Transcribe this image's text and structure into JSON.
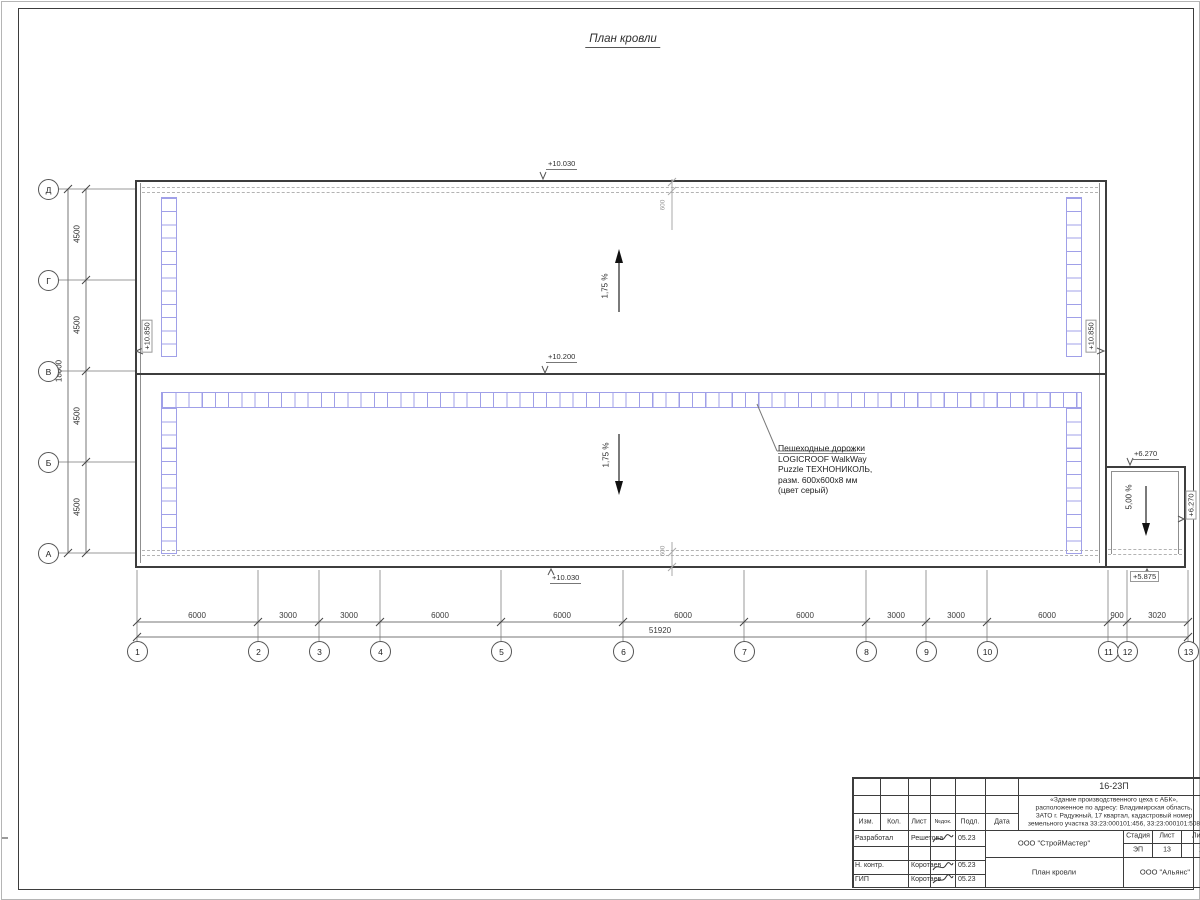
{
  "sheet": {
    "title": "План кровли"
  },
  "axes": {
    "bottom": [
      "1",
      "2",
      "3",
      "4",
      "5",
      "6",
      "7",
      "8",
      "9",
      "10",
      "11",
      "12",
      "13"
    ],
    "left": [
      "Д",
      "Г",
      "В",
      "Б",
      "А"
    ]
  },
  "dims": {
    "bottom": [
      "6000",
      "3000",
      "3000",
      "6000",
      "6000",
      "6000",
      "6000",
      "3000",
      "3000",
      "6000",
      "900",
      "3020"
    ],
    "bottom_total": "51920",
    "left": [
      "4500",
      "4500",
      "4500",
      "4500"
    ],
    "left_total": "18000",
    "offset_top": "600",
    "offset_bottom": "600"
  },
  "marks": {
    "top": "+10.030",
    "mid": "+10.200",
    "bottom": "+10.030",
    "left_wall": "+10.850",
    "right_wall": "+10.850",
    "annex_top": "+6.270",
    "annex_right": "+6.270",
    "annex_bottom": "+5.875"
  },
  "slopes": {
    "upper": "1,75 %",
    "lower": "1,75 %",
    "annex": "5,00 %"
  },
  "note": {
    "l1": "Пешеходные дорожки",
    "l2": "LOGICROOF WalkWay",
    "l3": "Puzzle ТЕХНОНИКОЛЬ,",
    "l4": "разм. 600х600х8 мм",
    "l5": "(цвет серый)"
  },
  "titleblock": {
    "doc": "16-23П",
    "proj1": "«Здание производственного цеха с АБК»,",
    "proj2": "расположенное по адресу: Владимирская область,",
    "proj3": "ЗАТО г. Радужный, 17 квартал, кадастровый номер",
    "proj4": "земельного участка 33:23:000101:456, 33:23:000101:508",
    "col_izm": "Изм.",
    "col_kol": "Кол.",
    "col_list": "Лист",
    "col_ndok": "№док.",
    "col_podl": "Подл.",
    "col_data": "Дата",
    "r1_role": "Разработал",
    "r1_name": "Решетова",
    "r1_date": "05.23",
    "r2_role": "Н. контр.",
    "r2_name": "Коротаев",
    "r2_date": "05.23",
    "r3_role": "ГИП",
    "r3_name": "Коротаев",
    "r3_date": "05.23",
    "org": "ООО \"СтройМастер\"",
    "stage_label": "Стадия",
    "sheet_label": "Лист",
    "sheets_label": "Лис",
    "stage": "ЭП",
    "sheet_no": "13",
    "sheets_total": "1",
    "drawing": "План кровли",
    "firm": "ООО \"Альянс\""
  },
  "colors": {
    "walkway": "#a0a0e8",
    "line": "#3d3d3d",
    "dim": "#8a8a8a"
  }
}
